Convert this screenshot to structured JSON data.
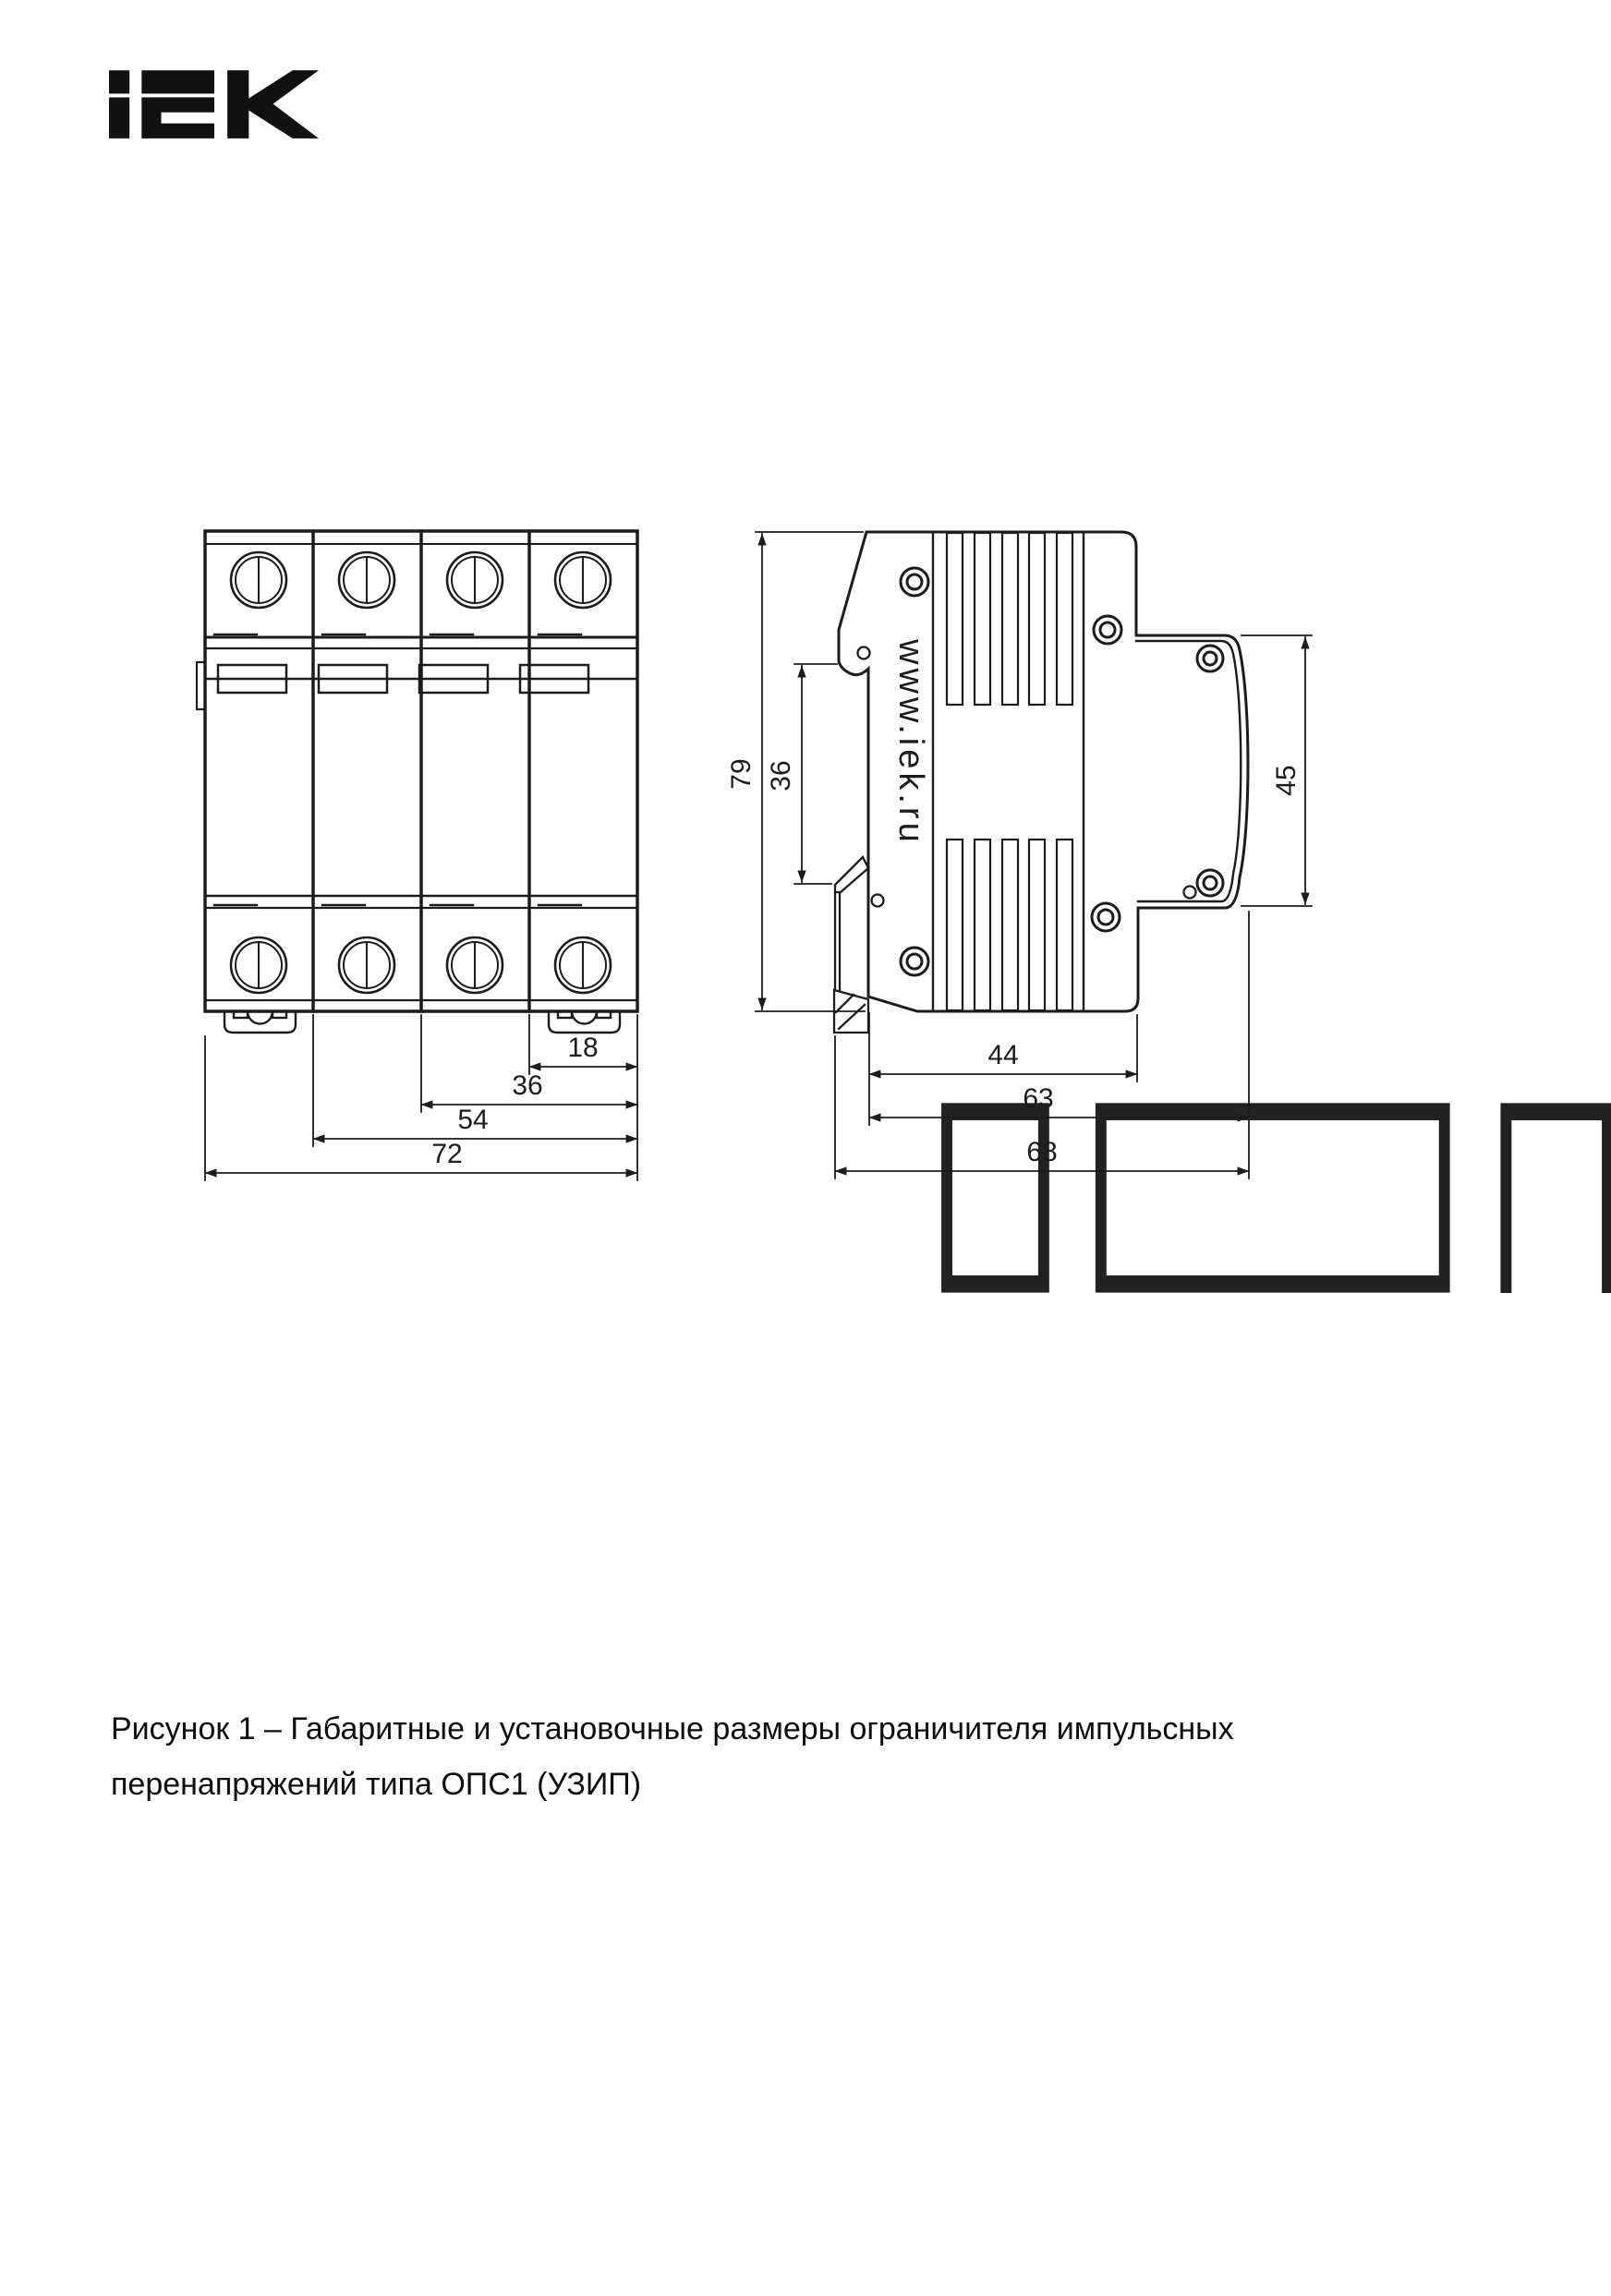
{
  "brand": {
    "logo_text": "iEK"
  },
  "front_view": {
    "dim_18": "18",
    "dim_36": "36",
    "dim_54": "54",
    "dim_72": "72"
  },
  "side_view": {
    "dim_79": "79",
    "dim_36": "36",
    "dim_45": "45",
    "dim_44": "44",
    "dim_63": "63",
    "dim_68": "68",
    "website": "www.iek.ru",
    "logo_text": "iEK"
  },
  "caption": {
    "line1": "Рисунок 1 – Габаритные и установочные размеры ограничителя импульсных",
    "line2": "перенапряжений типа ОПС1 (УЗИП)"
  }
}
